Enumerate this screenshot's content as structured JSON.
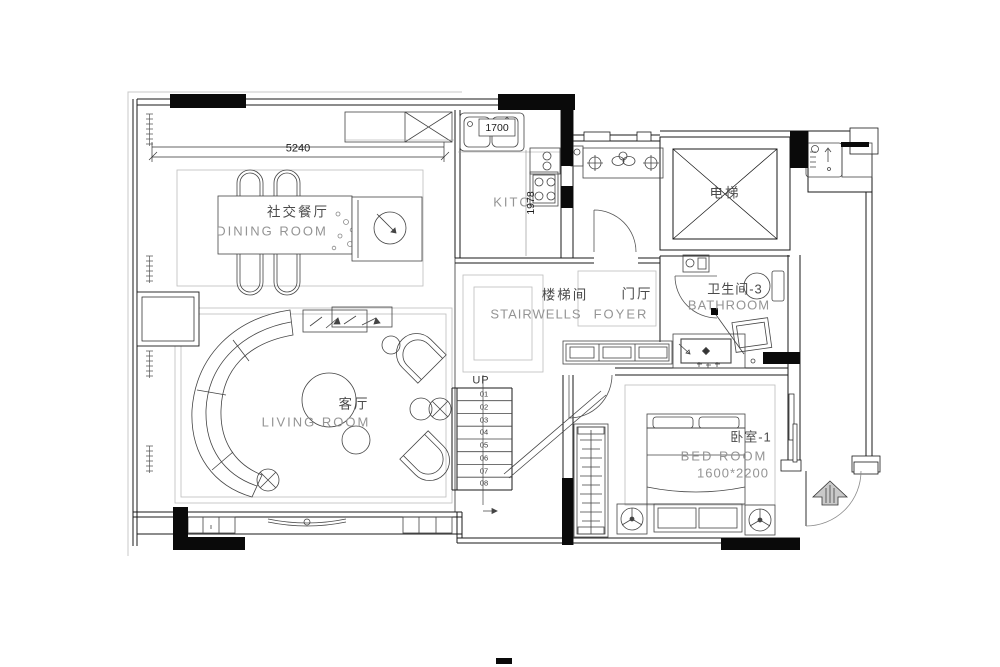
{
  "plan": {
    "rooms": {
      "dining": {
        "cn": "社交餐厅",
        "en": "DINING ROOM"
      },
      "kitchen": {
        "en": "KITC"
      },
      "elevator": {
        "cn": "电梯"
      },
      "stairwell": {
        "cn": "楼梯间",
        "en": "STAIRWELLS"
      },
      "foyer": {
        "cn": "门厅",
        "en": "FOYER"
      },
      "bathroom": {
        "cn": "卫生间-3",
        "en": "BATHROOM"
      },
      "living": {
        "cn": "客厅",
        "en": "LIVING ROOM"
      },
      "bedroom": {
        "cn": "卧室-1",
        "en": "BED ROOM",
        "size": "1600*2200"
      }
    },
    "dimensions": {
      "dining_width": "5240",
      "sink_width": "1700",
      "counter_depth": "1978"
    },
    "stairs": {
      "direction": "UP",
      "steps": [
        "01",
        "02",
        "03",
        "04",
        "05",
        "06",
        "07",
        "08"
      ]
    }
  },
  "colors": {
    "wall_line": "#1a1a1a",
    "wall_fill": "#0a0a0a",
    "furniture_line": "#444444",
    "guide_line": "#bcbcbc",
    "text_cn": "#4a4a4a",
    "text_en": "#949494",
    "text_dim": "#1c1c1c"
  }
}
